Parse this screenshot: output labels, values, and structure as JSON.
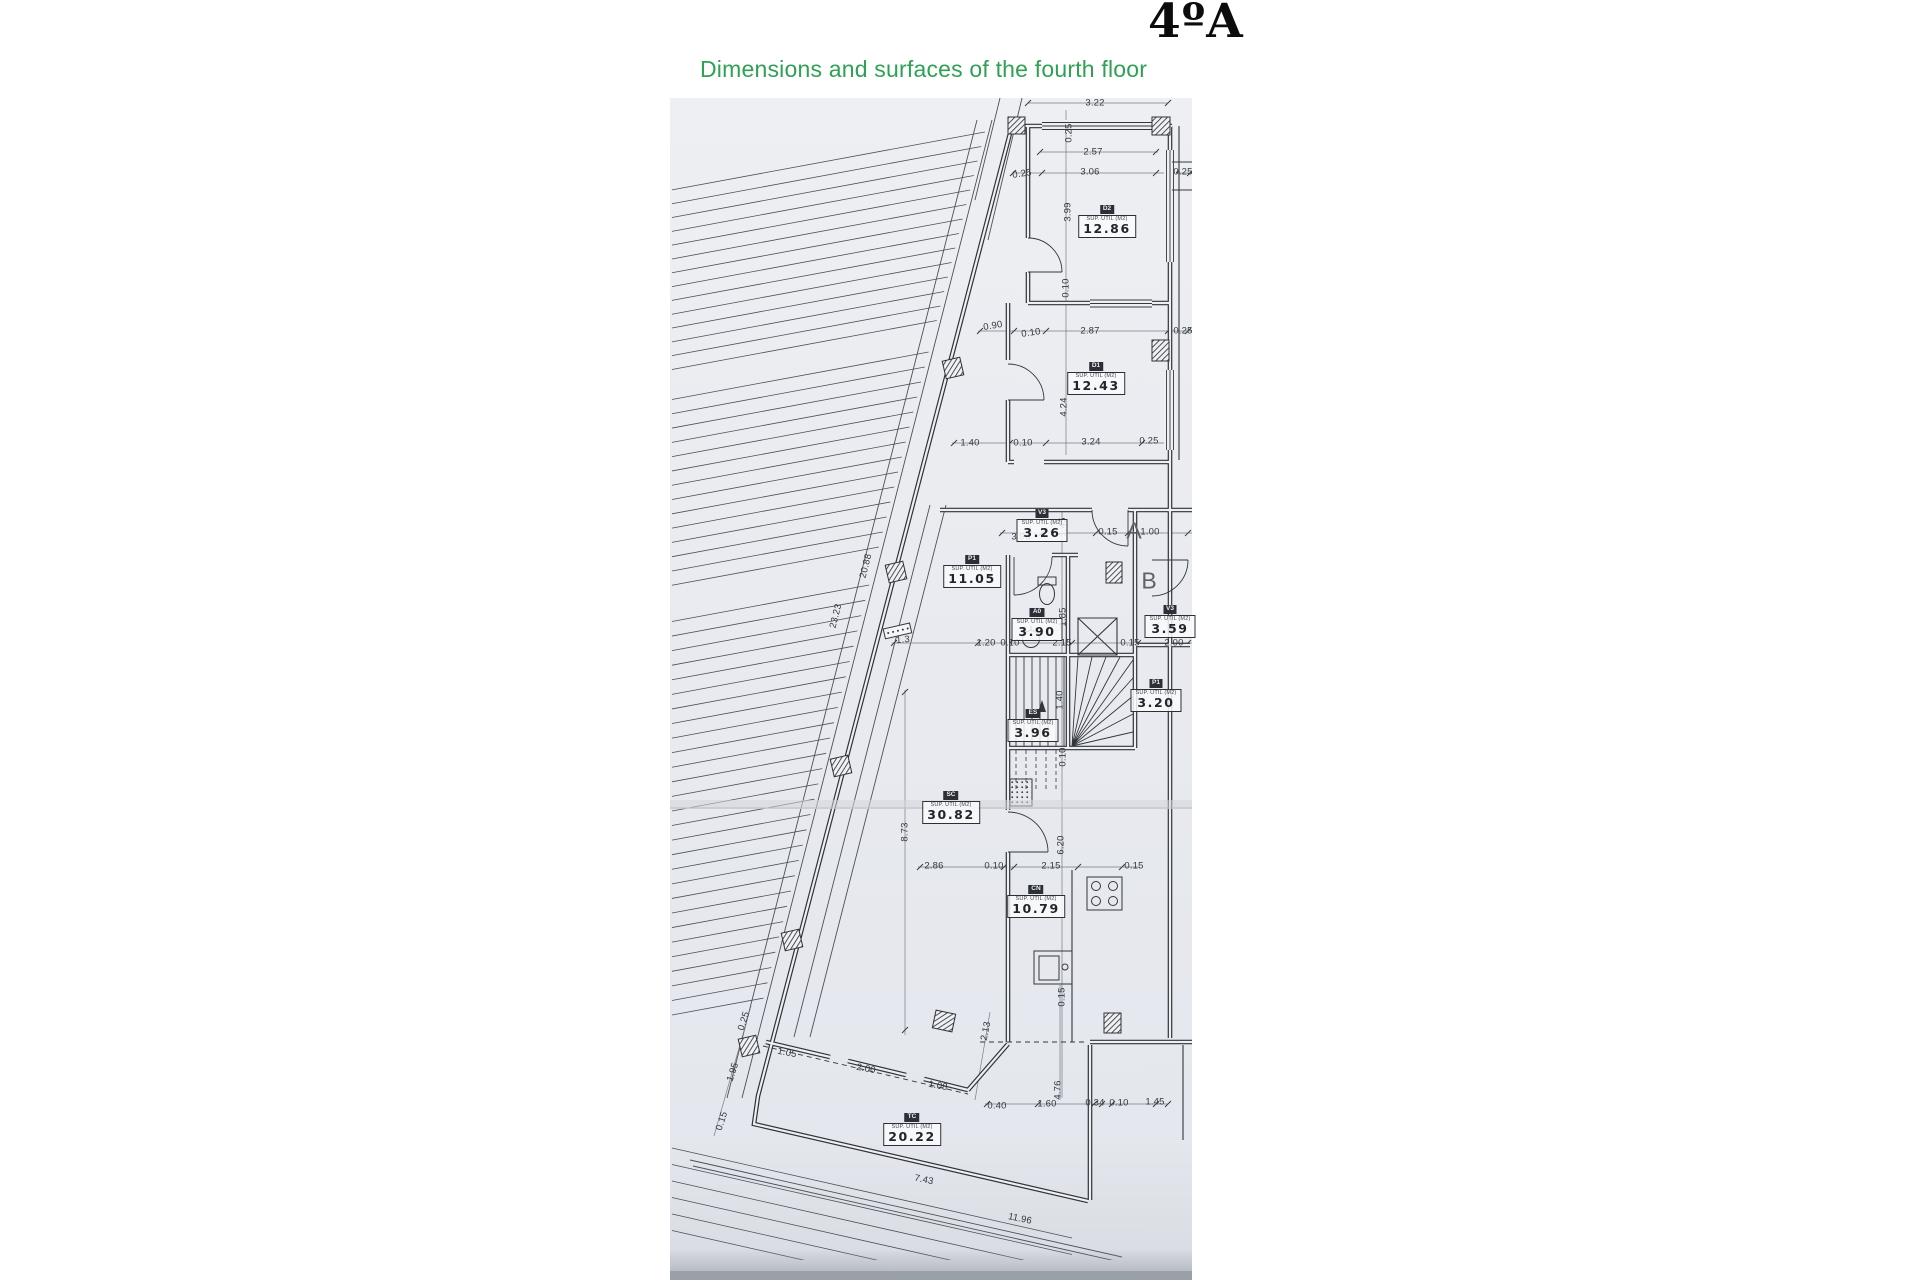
{
  "header": {
    "title": "4ºA",
    "subtitle": "Dimensions and surfaces of the fourth floor",
    "subtitle_color": "#2ea155"
  },
  "plan": {
    "caption": "SUP. UTIL (M2)",
    "paper_color": "#e9ebf0",
    "line_color": "#33383e",
    "rooms": [
      {
        "code": "D2",
        "area": "12.86",
        "x": 1107,
        "y": 218
      },
      {
        "code": "D1",
        "area": "12.43",
        "x": 1096,
        "y": 375
      },
      {
        "code": "V3",
        "area": "3.26",
        "x": 1042,
        "y": 522
      },
      {
        "code": "P1",
        "area": "11.05",
        "x": 972,
        "y": 568
      },
      {
        "code": "A0",
        "area": "3.90",
        "x": 1037,
        "y": 621
      },
      {
        "code": "V3",
        "area": "3.59",
        "x": 1170,
        "y": 618
      },
      {
        "code": "P1",
        "area": "3.20",
        "x": 1156,
        "y": 692
      },
      {
        "code": "ES",
        "area": "3.96",
        "x": 1033,
        "y": 722
      },
      {
        "code": "SC",
        "area": "30.82",
        "x": 951,
        "y": 804
      },
      {
        "code": "CN",
        "area": "10.79",
        "x": 1036,
        "y": 898
      },
      {
        "code": "TC",
        "area": "20.22",
        "x": 912,
        "y": 1126
      }
    ],
    "letters": [
      {
        "t": "A",
        "x": 1134,
        "y": 531
      },
      {
        "t": "B",
        "x": 1149,
        "y": 581
      }
    ],
    "dims": [
      {
        "t": "3.22",
        "x": 1095,
        "y": 103
      },
      {
        "t": "0.25",
        "x": 1069,
        "y": 133,
        "r": -90
      },
      {
        "t": "2.57",
        "x": 1093,
        "y": 152
      },
      {
        "t": "0.25",
        "x": 1022,
        "y": 174,
        "r": -8
      },
      {
        "t": "3.06",
        "x": 1090,
        "y": 172
      },
      {
        "t": "0.25",
        "x": 1183,
        "y": 172
      },
      {
        "t": "3.99",
        "x": 1068,
        "y": 212,
        "r": -90
      },
      {
        "t": "0.10",
        "x": 1066,
        "y": 288,
        "r": -90
      },
      {
        "t": "0.90",
        "x": 993,
        "y": 326,
        "r": -10
      },
      {
        "t": "0.10",
        "x": 1031,
        "y": 333,
        "r": -8
      },
      {
        "t": "2.87",
        "x": 1090,
        "y": 331
      },
      {
        "t": "0.25",
        "x": 1183,
        "y": 331
      },
      {
        "t": "4.24",
        "x": 1064,
        "y": 407,
        "r": -90
      },
      {
        "t": "1.40",
        "x": 970,
        "y": 443
      },
      {
        "t": "0.10",
        "x": 1023,
        "y": 443
      },
      {
        "t": "3.24",
        "x": 1091,
        "y": 442
      },
      {
        "t": "0.25",
        "x": 1149,
        "y": 441
      },
      {
        "t": "3.95",
        "x": 1021,
        "y": 537
      },
      {
        "t": "1.45",
        "x": 1063,
        "y": 527,
        "r": -90
      },
      {
        "t": "0.15",
        "x": 1108,
        "y": 532
      },
      {
        "t": "1.00",
        "x": 1150,
        "y": 532
      },
      {
        "t": "1.85",
        "x": 1063,
        "y": 617,
        "r": -90
      },
      {
        "t": "1.3",
        "x": 903,
        "y": 640,
        "r": -4
      },
      {
        "t": "1.20",
        "x": 986,
        "y": 643
      },
      {
        "t": "0.10",
        "x": 1010,
        "y": 643
      },
      {
        "t": "2.15",
        "x": 1062,
        "y": 643
      },
      {
        "t": "0.15",
        "x": 1130,
        "y": 643
      },
      {
        "t": "2.00",
        "x": 1174,
        "y": 643
      },
      {
        "t": "1.40",
        "x": 1060,
        "y": 700,
        "r": -90
      },
      {
        "t": "0.10",
        "x": 1063,
        "y": 757,
        "r": -90
      },
      {
        "t": "20.88",
        "x": 866,
        "y": 566,
        "r": -76
      },
      {
        "t": "23.23",
        "x": 836,
        "y": 616,
        "r": -76
      },
      {
        "t": "8.73",
        "x": 905,
        "y": 832,
        "r": -90
      },
      {
        "t": "6.20",
        "x": 1061,
        "y": 845,
        "r": -90
      },
      {
        "t": "2.86",
        "x": 934,
        "y": 866
      },
      {
        "t": "0.10",
        "x": 994,
        "y": 866
      },
      {
        "t": "2.15",
        "x": 1051,
        "y": 866
      },
      {
        "t": "0.15",
        "x": 1134,
        "y": 866
      },
      {
        "t": "0.15",
        "x": 1062,
        "y": 997,
        "r": -90
      },
      {
        "t": "2.13",
        "x": 986,
        "y": 1031,
        "r": -78
      },
      {
        "t": "0.25",
        "x": 744,
        "y": 1021,
        "r": -72
      },
      {
        "t": "1.95",
        "x": 733,
        "y": 1072,
        "r": -72
      },
      {
        "t": "1.05",
        "x": 787,
        "y": 1053,
        "r": 11
      },
      {
        "t": "2.00",
        "x": 866,
        "y": 1069,
        "r": 11
      },
      {
        "t": "1.08",
        "x": 938,
        "y": 1086,
        "r": 11
      },
      {
        "t": "0.15",
        "x": 722,
        "y": 1121,
        "r": -72
      },
      {
        "t": "4.76",
        "x": 1058,
        "y": 1090,
        "r": -90
      },
      {
        "t": "0.40",
        "x": 997,
        "y": 1106
      },
      {
        "t": "1.60",
        "x": 1047,
        "y": 1104
      },
      {
        "t": "0.34",
        "x": 1095,
        "y": 1103
      },
      {
        "t": "0.10",
        "x": 1119,
        "y": 1103
      },
      {
        "t": "1.45",
        "x": 1155,
        "y": 1102
      },
      {
        "t": "7.43",
        "x": 924,
        "y": 1180,
        "r": 12
      },
      {
        "t": "11.96",
        "x": 1020,
        "y": 1219,
        "r": 12
      }
    ]
  }
}
